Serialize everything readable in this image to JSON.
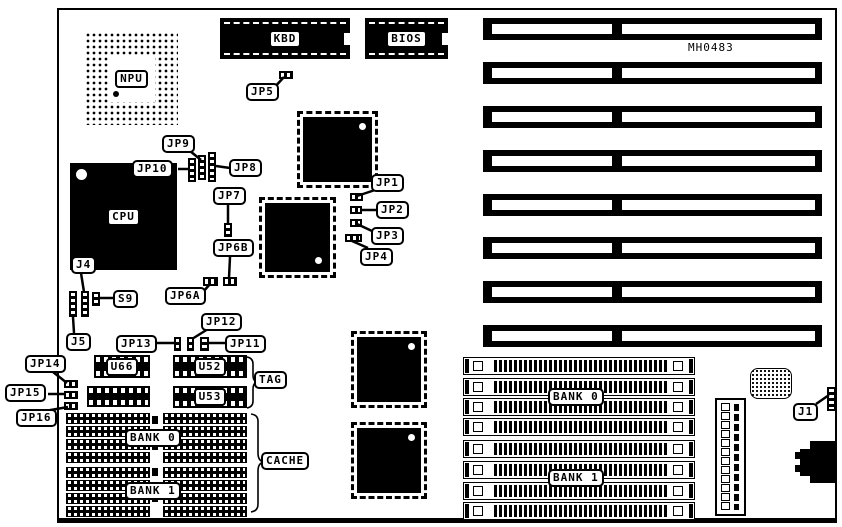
{
  "board": {
    "part_number": "MH0483",
    "line_color": "#000000",
    "background": "#ffffff"
  },
  "chips": {
    "npu": "NPU",
    "cpu": "CPU",
    "kbd": "KBD",
    "bios": "BIOS"
  },
  "dips": [
    {
      "id": "u66-chip",
      "label": "U66",
      "x": 94,
      "y": 355,
      "w": 56,
      "h": 23
    },
    {
      "id": "dip-below-u66",
      "label": "",
      "x": 87,
      "y": 386,
      "w": 63,
      "h": 21
    },
    {
      "id": "u52-chip",
      "label": "U52",
      "x": 173,
      "y": 355,
      "w": 74,
      "h": 23
    },
    {
      "id": "u53-chip",
      "label": "U53",
      "x": 173,
      "y": 386,
      "w": 74,
      "h": 22
    }
  ],
  "plates": [
    {
      "id": "tag-label",
      "text": "TAG",
      "x": 254,
      "y": 371
    },
    {
      "id": "cache-label",
      "text": "CACHE",
      "x": 261,
      "y": 452
    },
    {
      "id": "cache-bank0-label",
      "text": "BANK 0",
      "x": 125,
      "y": 429
    },
    {
      "id": "cache-bank1-label",
      "text": "BANK 1",
      "x": 125,
      "y": 482
    },
    {
      "id": "simm-bank0-label",
      "text": "BANK 0",
      "x": 548,
      "y": 388
    },
    {
      "id": "simm-bank1-label",
      "text": "BANK 1",
      "x": 548,
      "y": 469
    }
  ],
  "callouts": [
    {
      "id": "jp5-label",
      "text": "JP5",
      "x": 246,
      "y": 83,
      "leaders": [
        [
          272,
          90,
          284,
          77
        ]
      ]
    },
    {
      "id": "jp9-label",
      "text": "JP9",
      "x": 162,
      "y": 135,
      "leaders": [
        [
          190,
          151,
          201,
          160
        ]
      ]
    },
    {
      "id": "jp10-label",
      "text": "JP10",
      "x": 132,
      "y": 160,
      "leaders": [
        [
          178,
          169,
          189,
          169
        ]
      ]
    },
    {
      "id": "jp8-label",
      "text": "JP8",
      "x": 229,
      "y": 159,
      "leaders": [
        [
          230,
          168,
          216,
          166
        ]
      ]
    },
    {
      "id": "jp7-label",
      "text": "JP7",
      "x": 213,
      "y": 187,
      "leaders": [
        [
          228,
          204,
          228,
          224
        ]
      ]
    },
    {
      "id": "jp6b-label",
      "text": "JP6B",
      "x": 213,
      "y": 239,
      "leaders": [
        [
          230,
          257,
          229,
          278
        ]
      ]
    },
    {
      "id": "jp6a-label",
      "text": "JP6A",
      "x": 165,
      "y": 287,
      "leaders": [
        [
          203,
          292,
          210,
          284
        ]
      ]
    },
    {
      "id": "jp1-label",
      "text": "JP1",
      "x": 371,
      "y": 174,
      "leaders": [
        [
          375,
          190,
          357,
          196
        ]
      ]
    },
    {
      "id": "jp2-label",
      "text": "JP2",
      "x": 376,
      "y": 201,
      "leaders": [
        [
          376,
          210,
          362,
          210
        ]
      ]
    },
    {
      "id": "jp3-label",
      "text": "JP3",
      "x": 371,
      "y": 227,
      "leaders": [
        [
          372,
          231,
          357,
          224
        ]
      ]
    },
    {
      "id": "jp4-label",
      "text": "JP4",
      "x": 360,
      "y": 248,
      "leaders": [
        [
          368,
          248,
          352,
          241
        ]
      ]
    },
    {
      "id": "j4-label",
      "text": "J4",
      "x": 71,
      "y": 256,
      "leaders": [
        [
          81,
          273,
          84,
          292
        ]
      ]
    },
    {
      "id": "s9-label",
      "text": "S9",
      "x": 113,
      "y": 290,
      "leaders": [
        [
          113,
          298,
          100,
          298
        ]
      ]
    },
    {
      "id": "j5-label",
      "text": "J5",
      "x": 66,
      "y": 333,
      "leaders": [
        [
          74,
          333,
          73,
          317
        ]
      ]
    },
    {
      "id": "jp13-label",
      "text": "JP13",
      "x": 116,
      "y": 335,
      "leaders": [
        [
          156,
          343,
          175,
          343
        ]
      ]
    },
    {
      "id": "jp12-label",
      "text": "JP12",
      "x": 201,
      "y": 313,
      "leaders": [
        [
          208,
          329,
          192,
          339
        ]
      ]
    },
    {
      "id": "jp11-label",
      "text": "JP11",
      "x": 225,
      "y": 335,
      "leaders": [
        [
          225,
          343,
          209,
          343
        ]
      ]
    },
    {
      "id": "jp14-label",
      "text": "JP14",
      "x": 25,
      "y": 355,
      "leaders": [
        [
          53,
          372,
          67,
          383
        ]
      ]
    },
    {
      "id": "jp15-label",
      "text": "JP15",
      "x": 5,
      "y": 384,
      "leaders": [
        [
          48,
          394,
          64,
          394
        ]
      ]
    },
    {
      "id": "jp16-label",
      "text": "JP16",
      "x": 16,
      "y": 409,
      "leaders": [
        [
          45,
          411,
          68,
          407
        ]
      ]
    },
    {
      "id": "j1-label",
      "text": "J1",
      "x": 793,
      "y": 403,
      "leaders": [
        [
          816,
          404,
          829,
          395
        ]
      ]
    }
  ],
  "jumpers": [
    {
      "id": "jp5-jumper",
      "x": 279,
      "y": 71,
      "w": 14,
      "h": 8,
      "o": "h"
    },
    {
      "id": "jp10-header",
      "x": 188,
      "y": 158,
      "w": 8,
      "h": 24,
      "o": "v"
    },
    {
      "id": "jp9-header",
      "x": 198,
      "y": 155,
      "w": 8,
      "h": 25,
      "o": "v"
    },
    {
      "id": "jp8-header",
      "x": 208,
      "y": 152,
      "w": 8,
      "h": 30,
      "o": "v"
    },
    {
      "id": "jp7-jumper",
      "x": 224,
      "y": 223,
      "w": 8,
      "h": 14,
      "o": "v"
    },
    {
      "id": "jp6a-jumper",
      "x": 203,
      "y": 277,
      "w": 15,
      "h": 9,
      "o": "h"
    },
    {
      "id": "jp6b-jumper",
      "x": 223,
      "y": 277,
      "w": 14,
      "h": 9,
      "o": "h"
    },
    {
      "id": "jp1-jumper",
      "x": 350,
      "y": 193,
      "w": 13,
      "h": 8,
      "o": "h"
    },
    {
      "id": "jp2-jumper",
      "x": 350,
      "y": 206,
      "w": 12,
      "h": 8,
      "o": "h"
    },
    {
      "id": "jp3-jumper",
      "x": 350,
      "y": 219,
      "w": 12,
      "h": 8,
      "o": "h"
    },
    {
      "id": "jp4-jumper",
      "x": 345,
      "y": 234,
      "w": 17,
      "h": 8,
      "o": "h"
    },
    {
      "id": "j4-header-a",
      "x": 69,
      "y": 291,
      "w": 8,
      "h": 26,
      "o": "v"
    },
    {
      "id": "j4-header-b",
      "x": 81,
      "y": 291,
      "w": 8,
      "h": 26,
      "o": "v"
    },
    {
      "id": "s9-jumper",
      "x": 92,
      "y": 292,
      "w": 8,
      "h": 14,
      "o": "v"
    },
    {
      "id": "jp13-jumper",
      "x": 174,
      "y": 337,
      "w": 7,
      "h": 14,
      "o": "v"
    },
    {
      "id": "jp12-jumper",
      "x": 187,
      "y": 337,
      "w": 7,
      "h": 14,
      "o": "v"
    },
    {
      "id": "jp11-jumper",
      "x": 200,
      "y": 337,
      "w": 9,
      "h": 14,
      "o": "v"
    },
    {
      "id": "jp14-jumper",
      "x": 64,
      "y": 380,
      "w": 14,
      "h": 8,
      "o": "h"
    },
    {
      "id": "jp15-jumper",
      "x": 64,
      "y": 391,
      "w": 14,
      "h": 8,
      "o": "h"
    },
    {
      "id": "jp16-jumper",
      "x": 64,
      "y": 402,
      "w": 14,
      "h": 8,
      "o": "h"
    },
    {
      "id": "j1-header",
      "x": 827,
      "y": 387,
      "w": 9,
      "h": 24,
      "o": "v"
    }
  ],
  "qfps": [
    {
      "id": "qfp-chip-1",
      "x": 303,
      "y": 117,
      "w": 69,
      "h": 65,
      "dot": "tr"
    },
    {
      "id": "qfp-chip-2",
      "x": 265,
      "y": 203,
      "w": 65,
      "h": 69,
      "dot": "br"
    },
    {
      "id": "qfp-chip-3",
      "x": 357,
      "y": 337,
      "w": 64,
      "h": 65,
      "dot": "tr"
    },
    {
      "id": "qfp-chip-4",
      "x": 357,
      "y": 428,
      "w": 64,
      "h": 65,
      "dot": "tr"
    }
  ],
  "isa": {
    "x": 483,
    "w": 339,
    "h": 22,
    "seg1": [
      9,
      120
    ],
    "seg2": [
      139,
      193
    ],
    "slot_y": [
      18,
      62,
      106,
      150,
      194,
      237,
      281,
      325
    ]
  },
  "simm": {
    "x": 463,
    "w": 230,
    "h": 16,
    "socket_y": [
      357,
      378,
      398,
      418,
      440,
      461,
      482,
      502
    ]
  },
  "cache_chips": {
    "col_x": [
      66,
      163
    ],
    "w": 84,
    "h": 11,
    "row_y": [
      413,
      426,
      439,
      452,
      467,
      480,
      493,
      506
    ]
  },
  "power_connector": {
    "pin_count": 12
  }
}
